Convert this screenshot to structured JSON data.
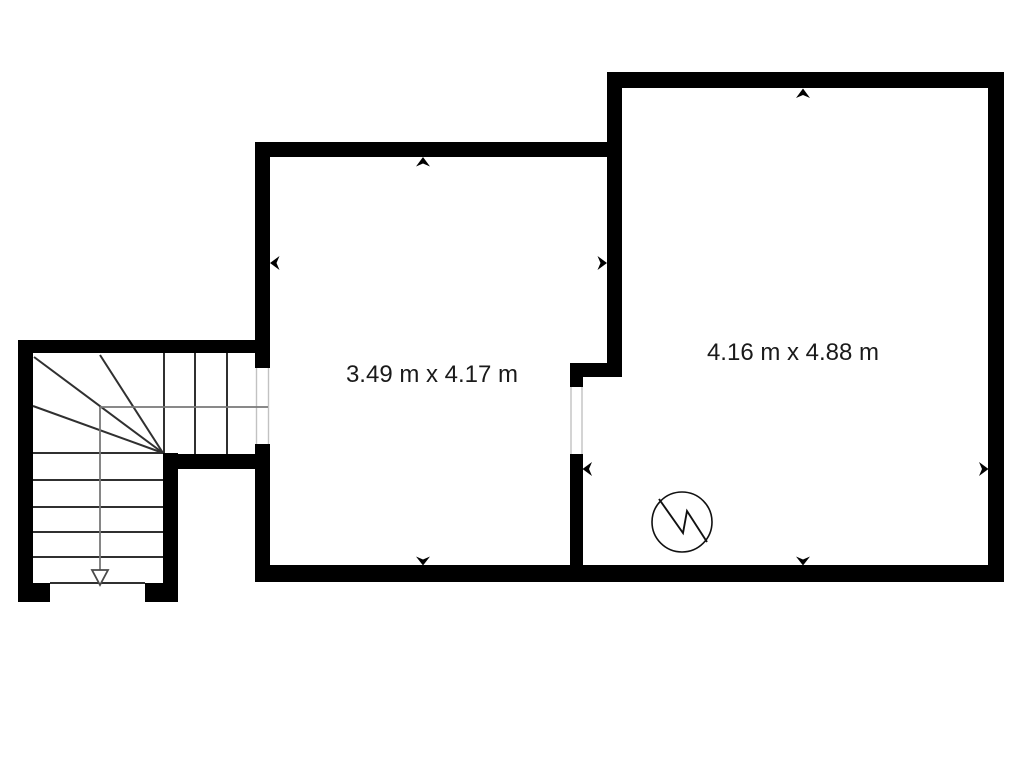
{
  "floorplan": {
    "title": "basement floor plan",
    "background_color": "#ffffff",
    "wall_color": "#000000",
    "walk_line_color": "#787878",
    "opening_line_color": "#c2c2c2",
    "rooms": [
      {
        "id": "left-room",
        "dimensions_label": "3.49 m x 4.17 m",
        "width_m": 3.49,
        "depth_m": 4.17
      },
      {
        "id": "right-room",
        "dimensions_label": "4.16 m x 4.88 m",
        "width_m": 4.16,
        "depth_m": 4.88
      }
    ],
    "stairs": {
      "type": "L-shaped winder staircase",
      "direction_arrow": "down",
      "straight_treads": 5,
      "winder_treads": 4,
      "upper_run_treads": 3
    },
    "symbols": [
      {
        "name": "water-heater-symbol",
        "shape": "circle-with-lightning-bolt"
      },
      {
        "name": "wall-direction-arrow-icon",
        "count": 8
      }
    ]
  }
}
